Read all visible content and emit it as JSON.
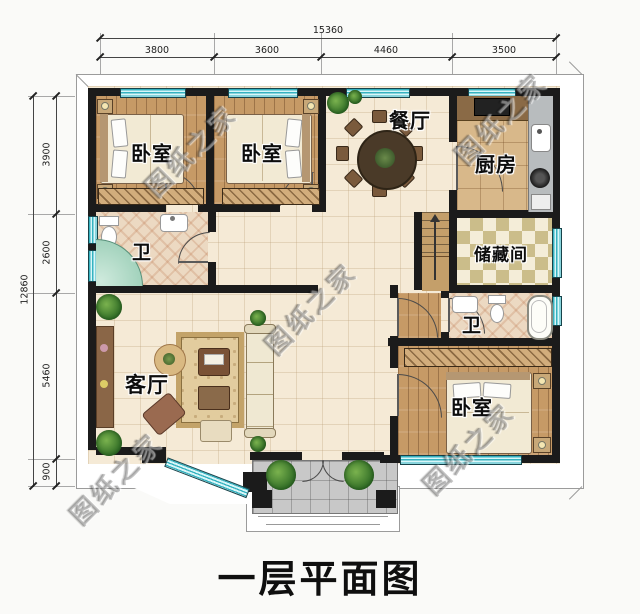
{
  "title": "一层平面图",
  "watermark_text": "图纸之家",
  "rooms": {
    "bedroom_top_left": "卧室",
    "bedroom_top_mid": "卧室",
    "bedroom_bottom_right": "卧室",
    "dining": "餐厅",
    "kitchen": "厨房",
    "storage": "储藏间",
    "bath_left": "卫",
    "bath_right": "卫",
    "living": "客厅"
  },
  "dimensions": {
    "top": {
      "total": "15360",
      "segments": [
        "3800",
        "3600",
        "4460",
        "3500"
      ]
    },
    "left": {
      "total": "12860",
      "segments": [
        "3900",
        "2600",
        "5460",
        "900"
      ]
    }
  },
  "colors": {
    "wall": "#1b1b1b",
    "window_glass": "#d9f6f8",
    "window_frame": "#35b2c0",
    "wood_floor": "#c69a66",
    "tile_floor": "#f5ead6",
    "kitchen_floor": "#d8b88a",
    "checker_dark": "#cbbd8a",
    "bath_floor": "#ecd9c2",
    "porch_floor": "#c8c8c8",
    "title_color": "#111111"
  }
}
